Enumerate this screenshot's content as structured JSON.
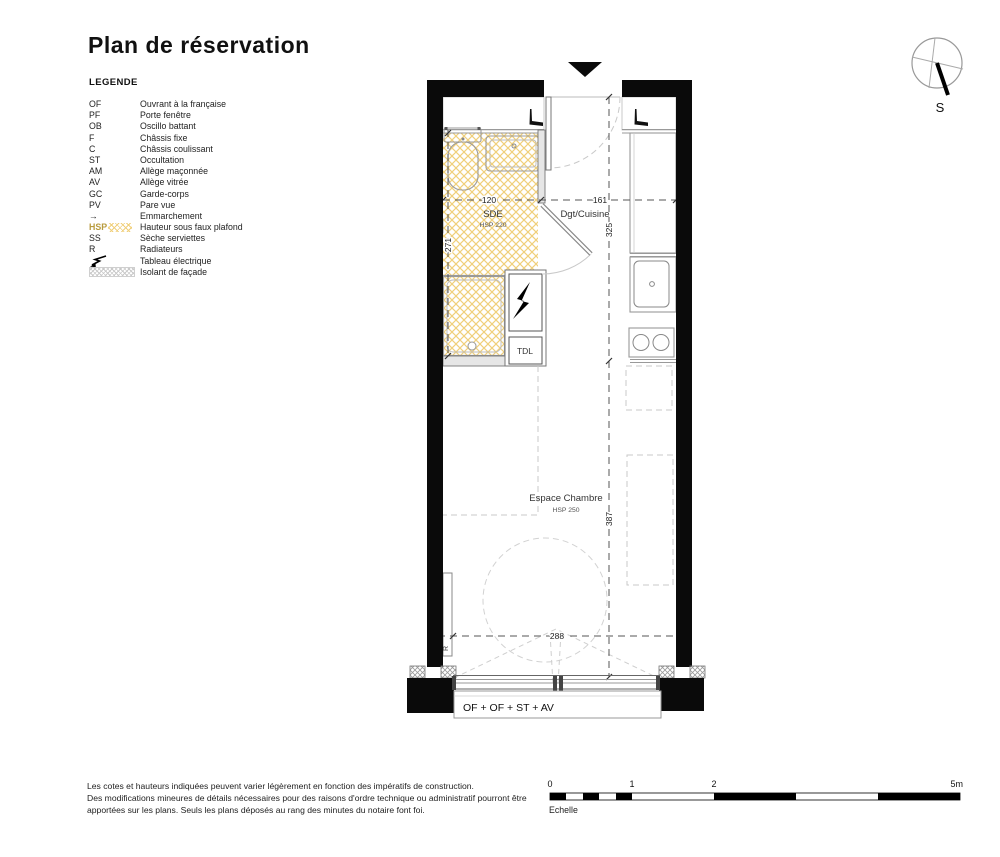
{
  "title": "Plan de réservation",
  "legend": {
    "heading": "LEGENDE",
    "items": [
      {
        "key": "OF",
        "label": "Ouvrant à la française"
      },
      {
        "key": "PF",
        "label": "Porte fenêtre"
      },
      {
        "key": "OB",
        "label": "Oscillo battant"
      },
      {
        "key": "F",
        "label": "Châssis fixe"
      },
      {
        "key": "C",
        "label": "Châssis coulissant"
      },
      {
        "key": "ST",
        "label": "Occultation"
      },
      {
        "key": "AM",
        "label": "Allège maçonnée"
      },
      {
        "key": "AV",
        "label": "Allège vitrée"
      },
      {
        "key": "GC",
        "label": "Garde-corps"
      },
      {
        "key": "PV",
        "label": "Pare vue"
      },
      {
        "key": "→",
        "label": "Emmarchement"
      },
      {
        "key": "HSP",
        "label": "Hauteur sous faux plafond"
      },
      {
        "key": "SS",
        "label": "Sèche serviettes"
      },
      {
        "key": "R",
        "label": "Radiateurs"
      },
      {
        "key": "",
        "label": "Tableau électrique",
        "icon": "lightning-icon"
      },
      {
        "key": "",
        "label": "Isolant de façade",
        "icon": "facade-insulation-swatch"
      }
    ]
  },
  "plan": {
    "rooms": {
      "sde": {
        "name": "SDE",
        "hsp": "HSP 220"
      },
      "dgt": {
        "name": "Dgt/Cuisine"
      },
      "chambre": {
        "name": "Espace Chambre",
        "hsp": "HSP 250"
      }
    },
    "dims": {
      "sde_width": "120",
      "dgt_width": "161",
      "sde_depth": "271",
      "dgt_depth": "325",
      "chambre_depth": "387",
      "window_span": "288"
    },
    "labels": {
      "tdl": "TDL",
      "radiator": "R",
      "window_bay": "OF + OF + ST + AV"
    }
  },
  "compass": {
    "south": "S"
  },
  "scalebar": {
    "tick0": "0",
    "tick1": "1",
    "tick2": "2",
    "tick5": "5m",
    "caption": "Echelle"
  },
  "footer": {
    "line1": "Les cotes et hauteurs indiquées peuvent varier légèrement en fonction des impératifs de construction.",
    "line2": "Des modifications mineures de détails nécessaires pour des raisons d'ordre technique ou administratif pourront être",
    "line3": "apportées sur les plans. Seuls les plans déposés au rang des minutes du notaire font foi."
  },
  "colors": {
    "wall": "#0a0a0a",
    "floor_hatch": "#f0cf7a",
    "hsp_accent": "#b89b3e"
  }
}
